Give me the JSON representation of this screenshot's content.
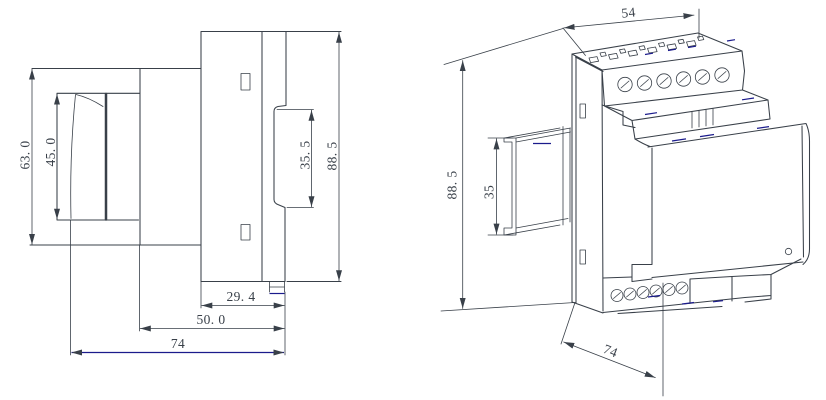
{
  "drawing": {
    "colors": {
      "line": "#394049",
      "hidden_line_blue": "#1b1b8c",
      "background": "#ffffff"
    },
    "side_view": {
      "dim_step_height": "63. 0",
      "dim_clip_height": "45. 0",
      "dim_window_height": "35. 5",
      "dim_total_height": "88. 5",
      "dim_terminal_depth": "29. 4",
      "dim_body_depth": "50. 0",
      "dim_total_depth": "74"
    },
    "iso_view": {
      "dim_width": "54",
      "dim_total_height": "88. 5",
      "dim_rail_height": "35",
      "dim_total_depth": "74"
    }
  }
}
